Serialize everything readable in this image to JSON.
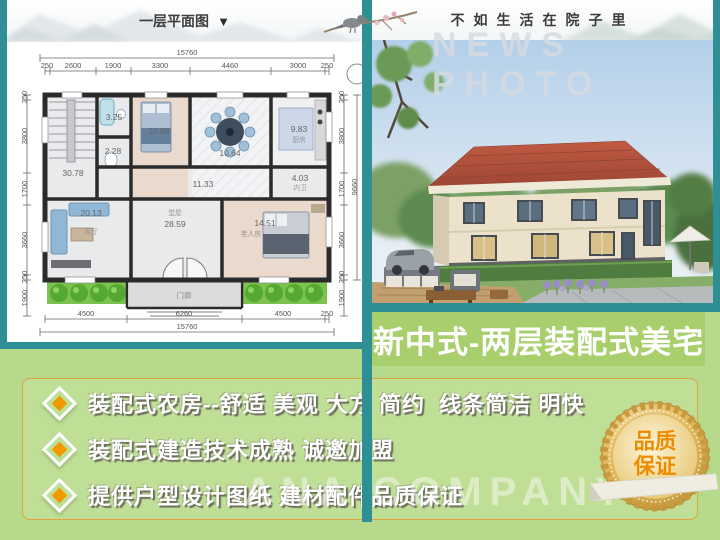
{
  "header": {
    "plan_title": "一层平面图",
    "plan_title_arrow": "▼",
    "motto": "不如生活在院子里"
  },
  "photo": {
    "watermark": "NEWS PHOTO"
  },
  "banner": {
    "title": "新中式-两层装配式美宅"
  },
  "features": {
    "items": [
      {
        "text": "装配式农房--舒适 美观 大方 简约  线条简洁 明快"
      },
      {
        "text": "装配式建造技术成熟 诚邀加盟"
      },
      {
        "text": "提供户型设计图纸 建材配件品质保证"
      }
    ]
  },
  "seal": {
    "line1": "品质",
    "line2": "保证"
  },
  "bottom_watermark": "ANA COMPANY",
  "floor_plan": {
    "overall_width": "15760",
    "overall_height": "9660",
    "top_dims": [
      "250",
      "2600",
      "1900",
      "3300",
      "4460",
      "3000",
      "250"
    ],
    "bottom_dims": [
      "4500",
      "6260",
      "4500",
      "250"
    ],
    "bottom_overall": "15760",
    "side_dims": [
      "250",
      "3800",
      "1700",
      "3660",
      "250",
      "1900"
    ],
    "rooms": {
      "stair": "30.78",
      "bath1": "3.25",
      "closet": "2.28",
      "bedroom": "10.89",
      "dining": "10.64",
      "kitchen": "9.83",
      "kitchen_name": "厨房",
      "corridor": "11.33",
      "bath2": "4.03",
      "bath2_name": "内卫",
      "living": "20.13",
      "living_name": "客厅",
      "hall": "28.59",
      "hall_name": "堂屋",
      "elder": "14.51",
      "elder_name": "老人房",
      "porch_name": "门廊"
    }
  },
  "colors": {
    "teal": "#2e8f94",
    "banner_green": "#a9cf6d",
    "panel_green": "#b7d98c",
    "box_border": "#dfa43f",
    "bullet_orange": "#f09a00",
    "roof_red": "#b05340",
    "seal_text": "#ef8b00"
  }
}
